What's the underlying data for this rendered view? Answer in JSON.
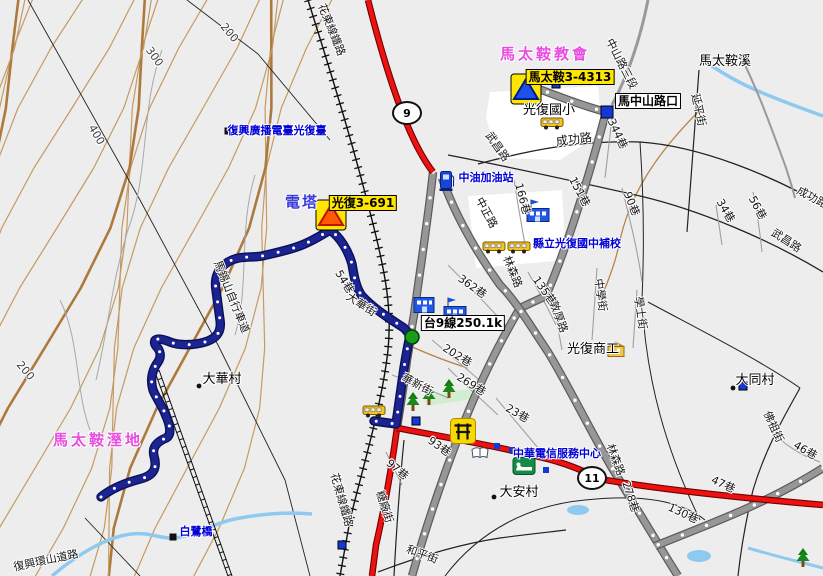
{
  "map_title": "光復鄉 馬太鞍 地圖",
  "colors": {
    "background": "#ededed",
    "contour": "#c49a62",
    "contour_bold": "#ad7a3e",
    "highway_red": "#ec1212",
    "major_road_gray": "#979797",
    "route_navy": "#1c2492",
    "stream_blue": "#8ec9ef",
    "poi_text_blue": "#0000d6",
    "place_text_magenta": "#e84ce0",
    "badge_yellow": "#ffe600"
  },
  "shields": [
    {
      "n": "highway-9-shield",
      "t": "9",
      "x": 407,
      "y": 113
    },
    {
      "n": "highway-11-shield",
      "t": "11",
      "x": 592,
      "y": 478
    }
  ],
  "labels": [
    {
      "n": "label-matai-church",
      "t": "馬太鞍教會",
      "x": 545,
      "y": 54,
      "r": 0,
      "c": "place"
    },
    {
      "n": "label-matai-wetland",
      "t": "馬太鞍溼地",
      "x": 98,
      "y": 440,
      "r": 0,
      "c": "place"
    },
    {
      "n": "label-power-tower",
      "t": "電塔",
      "x": 302,
      "y": 202,
      "r": 0,
      "c": "tower"
    },
    {
      "n": "badge-matai-3-4313",
      "t": "馬太鞍3-4313",
      "x": 570,
      "y": 77,
      "r": 0,
      "c": "badge"
    },
    {
      "n": "badge-guangfu-3-691",
      "t": "光復3-691",
      "x": 363,
      "y": 203,
      "r": 0,
      "c": "badge"
    },
    {
      "n": "box-ma-zhongshan-intersection",
      "t": "馬中山路口",
      "x": 648,
      "y": 101,
      "r": 0,
      "c": "box"
    },
    {
      "n": "box-highway9-milestone",
      "t": "台9線250.1k",
      "x": 463,
      "y": 323,
      "r": 0,
      "c": "box"
    },
    {
      "n": "label-fuxing-radio-station",
      "t": "復興廣播電臺光復臺",
      "x": 277,
      "y": 131,
      "r": 0,
      "c": "poi"
    },
    {
      "n": "label-cpc-gas-station",
      "t": "中油加油站",
      "x": 486,
      "y": 178,
      "r": 0,
      "c": "poi"
    },
    {
      "n": "label-guangfu-junior-high-supplementary",
      "t": "縣立光復國中補校",
      "x": 577,
      "y": 244,
      "r": 0,
      "c": "poi"
    },
    {
      "n": "label-chunghwa-telecom-center",
      "t": "中華電信服務中心",
      "x": 557,
      "y": 454,
      "r": 0,
      "c": "poi"
    },
    {
      "n": "label-bailu-bridge",
      "t": "白鷺橋",
      "x": 196,
      "y": 532,
      "r": 0,
      "c": "poi"
    },
    {
      "n": "label-guangfu-elementary",
      "t": "光復國小",
      "x": 549,
      "y": 111,
      "r": 0,
      "c": "village"
    },
    {
      "n": "label-guangfu-vocational",
      "t": "光復商工",
      "x": 593,
      "y": 350,
      "r": 0,
      "c": "village"
    },
    {
      "n": "label-dahua-village",
      "t": "大華村",
      "x": 222,
      "y": 380,
      "r": 0,
      "c": "village"
    },
    {
      "n": "label-daan-village",
      "t": "大安村",
      "x": 519,
      "y": 493,
      "r": 0,
      "c": "village"
    },
    {
      "n": "label-datong-village",
      "t": "大同村",
      "x": 755,
      "y": 381,
      "r": 0,
      "c": "village"
    },
    {
      "n": "label-matai-creek",
      "t": "馬太鞍溪",
      "x": 725,
      "y": 62,
      "r": 0,
      "c": "village"
    },
    {
      "n": "label-chenggong-rd-w",
      "t": "成功路",
      "x": 574,
      "y": 140,
      "r": -7,
      "c": "streetlg"
    },
    {
      "n": "label-chenggong-rd-e",
      "t": "成功路",
      "x": 812,
      "y": 198,
      "r": 28,
      "c": "street"
    },
    {
      "n": "label-wuchang-rd-w",
      "t": "武昌路",
      "x": 497,
      "y": 147,
      "r": 55,
      "c": "street"
    },
    {
      "n": "label-wuchang-rd-e",
      "t": "武昌路",
      "x": 786,
      "y": 241,
      "r": 33,
      "c": "street"
    },
    {
      "n": "label-zhongshan-rd-sec3",
      "t": "中山路三段",
      "x": 621,
      "y": 64,
      "r": 63,
      "c": "street"
    },
    {
      "n": "label-yanping-st",
      "t": "延平街",
      "x": 698,
      "y": 110,
      "r": 78,
      "c": "street"
    },
    {
      "n": "label-lane-344",
      "t": "344巷",
      "x": 617,
      "y": 134,
      "r": 65,
      "c": "street"
    },
    {
      "n": "label-lane-34",
      "t": "34巷",
      "x": 725,
      "y": 211,
      "r": 60,
      "c": "street"
    },
    {
      "n": "label-lane-56",
      "t": "56巷",
      "x": 757,
      "y": 208,
      "r": 62,
      "c": "street"
    },
    {
      "n": "label-lane-90",
      "t": "90巷",
      "x": 631,
      "y": 204,
      "r": 68,
      "c": "street"
    },
    {
      "n": "label-lane-151",
      "t": "151巷",
      "x": 579,
      "y": 192,
      "r": 62,
      "c": "street"
    },
    {
      "n": "label-lane-166",
      "t": "166巷",
      "x": 522,
      "y": 199,
      "r": 75,
      "c": "street"
    },
    {
      "n": "label-lane-362",
      "t": "362巷",
      "x": 472,
      "y": 287,
      "r": 35,
      "c": "street"
    },
    {
      "n": "label-lane-135",
      "t": "135巷",
      "x": 544,
      "y": 291,
      "r": 55,
      "c": "street"
    },
    {
      "n": "label-zhongxue-st",
      "t": "中學街",
      "x": 600,
      "y": 295,
      "r": 82,
      "c": "street"
    },
    {
      "n": "label-xueshi-st",
      "t": "學士街",
      "x": 640,
      "y": 313,
      "r": 82,
      "c": "street"
    },
    {
      "n": "label-dunhou-rd",
      "t": "敦厚路",
      "x": 558,
      "y": 317,
      "r": 70,
      "c": "street"
    },
    {
      "n": "label-linsen-rd-n",
      "t": "林森路",
      "x": 512,
      "y": 272,
      "r": 68,
      "c": "street"
    },
    {
      "n": "label-linsen-rd-s",
      "t": "林森路",
      "x": 615,
      "y": 460,
      "r": 70,
      "c": "street"
    },
    {
      "n": "label-zhongzheng-rd",
      "t": "中正路",
      "x": 486,
      "y": 213,
      "r": 62,
      "c": "street"
    },
    {
      "n": "label-dahua-st",
      "t": "大華街",
      "x": 361,
      "y": 305,
      "r": 33,
      "c": "street"
    },
    {
      "n": "label-lane-54",
      "t": "54巷",
      "x": 344,
      "y": 282,
      "r": 58,
      "c": "street"
    },
    {
      "n": "label-lane-202",
      "t": "202巷",
      "x": 457,
      "y": 356,
      "r": 32,
      "c": "street"
    },
    {
      "n": "label-lane-269",
      "t": "269巷",
      "x": 471,
      "y": 385,
      "r": 32,
      "c": "street"
    },
    {
      "n": "label-lane-23",
      "t": "23巷",
      "x": 517,
      "y": 414,
      "r": 30,
      "c": "street"
    },
    {
      "n": "label-lane-93",
      "t": "93巷",
      "x": 439,
      "y": 447,
      "r": 35,
      "c": "street"
    },
    {
      "n": "label-lane-97",
      "t": "97巷",
      "x": 397,
      "y": 470,
      "r": 40,
      "c": "street"
    },
    {
      "n": "label-tangchang-st",
      "t": "糖廠街",
      "x": 384,
      "y": 507,
      "r": 72,
      "c": "street"
    },
    {
      "n": "label-heping-st",
      "t": "和平街",
      "x": 422,
      "y": 555,
      "r": 20,
      "c": "street"
    },
    {
      "n": "label-huaxin-st",
      "t": "華新街",
      "x": 417,
      "y": 385,
      "r": 28,
      "c": "street"
    },
    {
      "n": "label-fozu-st",
      "t": "佛祖街",
      "x": 773,
      "y": 427,
      "r": 65,
      "c": "street"
    },
    {
      "n": "label-lane-46",
      "t": "46巷",
      "x": 805,
      "y": 451,
      "r": 30,
      "c": "street"
    },
    {
      "n": "label-lane-47",
      "t": "47巷",
      "x": 723,
      "y": 485,
      "r": 25,
      "c": "street"
    },
    {
      "n": "label-lane-130",
      "t": "130巷",
      "x": 683,
      "y": 514,
      "r": 25,
      "c": "street"
    },
    {
      "n": "label-lane-278",
      "t": "278巷",
      "x": 630,
      "y": 497,
      "r": 72,
      "c": "street"
    },
    {
      "n": "label-huadong-railway-n",
      "t": "花東線鐵路",
      "x": 331,
      "y": 30,
      "r": 68,
      "c": "street"
    },
    {
      "n": "label-huadong-railway-s",
      "t": "花東線鐵路",
      "x": 341,
      "y": 500,
      "r": 74,
      "c": "street"
    },
    {
      "n": "label-bikeway",
      "t": "馬錫山自行車道",
      "x": 231,
      "y": 297,
      "r": 68,
      "c": "street"
    },
    {
      "n": "label-huanshan-rd",
      "t": "復興環山道路",
      "x": 46,
      "y": 561,
      "r": -12,
      "c": "street"
    },
    {
      "n": "label-contour-200-n",
      "t": "200",
      "x": 229,
      "y": 33,
      "r": 50,
      "c": "contour"
    },
    {
      "n": "label-contour-300",
      "t": "300",
      "x": 154,
      "y": 57,
      "r": 55,
      "c": "contour"
    },
    {
      "n": "label-contour-400",
      "t": "400",
      "x": 96,
      "y": 135,
      "r": 60,
      "c": "contour"
    },
    {
      "n": "label-contour-200-s",
      "t": "200",
      "x": 25,
      "y": 371,
      "r": 50,
      "c": "contour"
    }
  ],
  "markers": [
    {
      "n": "warning-marker-blue-icon",
      "k": "tri-blue",
      "x": 526,
      "y": 89
    },
    {
      "n": "warning-marker-red-icon",
      "k": "tri-red",
      "x": 331,
      "y": 215
    },
    {
      "n": "intersection-square-icon",
      "k": "bsq-lg",
      "x": 607,
      "y": 112
    },
    {
      "n": "poi-square-icon",
      "k": "bsq",
      "x": 743,
      "y": 386
    },
    {
      "n": "poi-square-icon",
      "k": "bsq",
      "x": 342,
      "y": 545
    },
    {
      "n": "poi-square-icon",
      "k": "bsq",
      "x": 416,
      "y": 421
    },
    {
      "n": "poi-square-icon",
      "k": "bsq",
      "x": 556,
      "y": 84
    },
    {
      "n": "poi-square-small-icon",
      "k": "bsq-sm",
      "x": 497,
      "y": 446
    },
    {
      "n": "poi-square-small-icon",
      "k": "bsq-sm",
      "x": 512,
      "y": 450
    },
    {
      "n": "poi-square-small-icon",
      "k": "bsq-sm",
      "x": 546,
      "y": 470
    },
    {
      "n": "radio-station-marker-icon",
      "k": "ksq",
      "x": 228,
      "y": 131
    },
    {
      "n": "bridge-marker-icon",
      "k": "ksq",
      "x": 173,
      "y": 537
    },
    {
      "n": "village-dot-icon",
      "k": "dot",
      "x": 199,
      "y": 386
    },
    {
      "n": "village-dot-icon",
      "k": "dot",
      "x": 494,
      "y": 497
    },
    {
      "n": "village-dot-icon",
      "k": "dot",
      "x": 733,
      "y": 388
    },
    {
      "n": "route-start-icon",
      "k": "gcirc",
      "x": 412,
      "y": 337
    },
    {
      "n": "gas-station-icon",
      "k": "pump",
      "x": 447,
      "y": 181
    },
    {
      "n": "school-bus-icon",
      "k": "bus",
      "x": 552,
      "y": 123
    },
    {
      "n": "school-bus-icon",
      "k": "bus",
      "x": 494,
      "y": 247
    },
    {
      "n": "school-bus-icon",
      "k": "bus",
      "x": 519,
      "y": 247
    },
    {
      "n": "school-bus-icon",
      "k": "bus",
      "x": 374,
      "y": 411
    },
    {
      "n": "school-building-icon",
      "k": "bldg-flag",
      "x": 538,
      "y": 211
    },
    {
      "n": "school-building-icon",
      "k": "bldg-flag",
      "x": 455,
      "y": 309
    },
    {
      "n": "building-icon",
      "k": "bldg",
      "x": 424,
      "y": 305
    },
    {
      "n": "vocational-school-icon",
      "k": "bldg-y",
      "x": 616,
      "y": 349
    },
    {
      "n": "temple-icon",
      "k": "temple",
      "x": 463,
      "y": 431
    },
    {
      "n": "library-book-icon",
      "k": "book",
      "x": 480,
      "y": 453
    },
    {
      "n": "hotel-icon",
      "k": "hotel",
      "x": 524,
      "y": 466
    },
    {
      "n": "park-tree-icon",
      "k": "tree",
      "x": 413,
      "y": 402
    },
    {
      "n": "park-tree-icon",
      "k": "tree",
      "x": 429,
      "y": 396
    },
    {
      "n": "park-tree-icon",
      "k": "tree",
      "x": 449,
      "y": 389
    },
    {
      "n": "park-tree-icon",
      "k": "tree",
      "x": 803,
      "y": 558
    }
  ]
}
